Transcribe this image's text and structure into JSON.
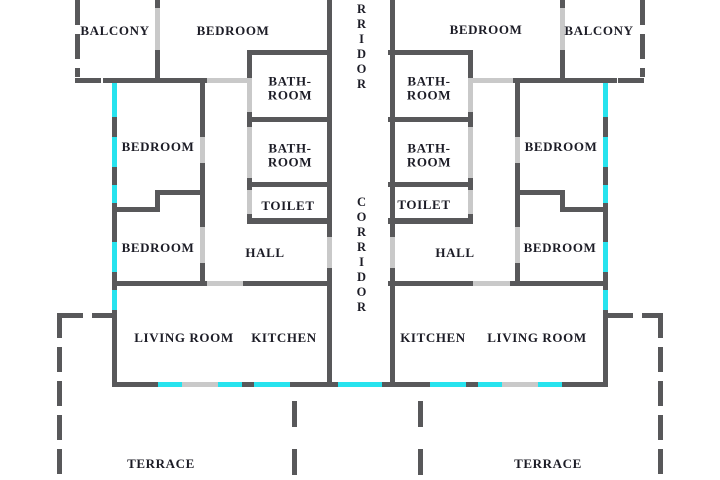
{
  "plan": {
    "type": "apartment-floor-plan",
    "colors": {
      "wall": "#58585a",
      "door_opening": "#c9c9c9",
      "window": "#27e3ee",
      "background": "#ffffff",
      "text": "#1c1c26"
    },
    "corridor": {
      "top": "CORRIDOR",
      "middle": "CORRIDOR"
    },
    "rooms": {
      "balcony_left": "BALCONY",
      "bedroom_top_left": "BEDROOM",
      "bedroom_top_right": "BEDROOM",
      "balcony_right": "BALCONY",
      "bathroom_upper_left": "BATH-\nROOM",
      "bathroom_lower_left": "BATH-\nROOM",
      "toilet_left": "TOILET",
      "bathroom_upper_right": "BATH-\nROOM",
      "bathroom_lower_right": "BATH-\nROOM",
      "toilet_right": "TOILET",
      "bedroom_mid_left": "BEDROOM",
      "bedroom_low_left": "BEDROOM",
      "bedroom_mid_right": "BEDROOM",
      "bedroom_low_right": "BEDROOM",
      "hall_left": "HALL",
      "hall_right": "HALL",
      "living_room_left": "LIVING ROOM",
      "kitchen_left": "KITCHEN",
      "kitchen_right": "KITCHEN",
      "living_room_right": "LIVING ROOM",
      "terrace_left": "TERRACE",
      "terrace_right": "TERRACE"
    }
  }
}
